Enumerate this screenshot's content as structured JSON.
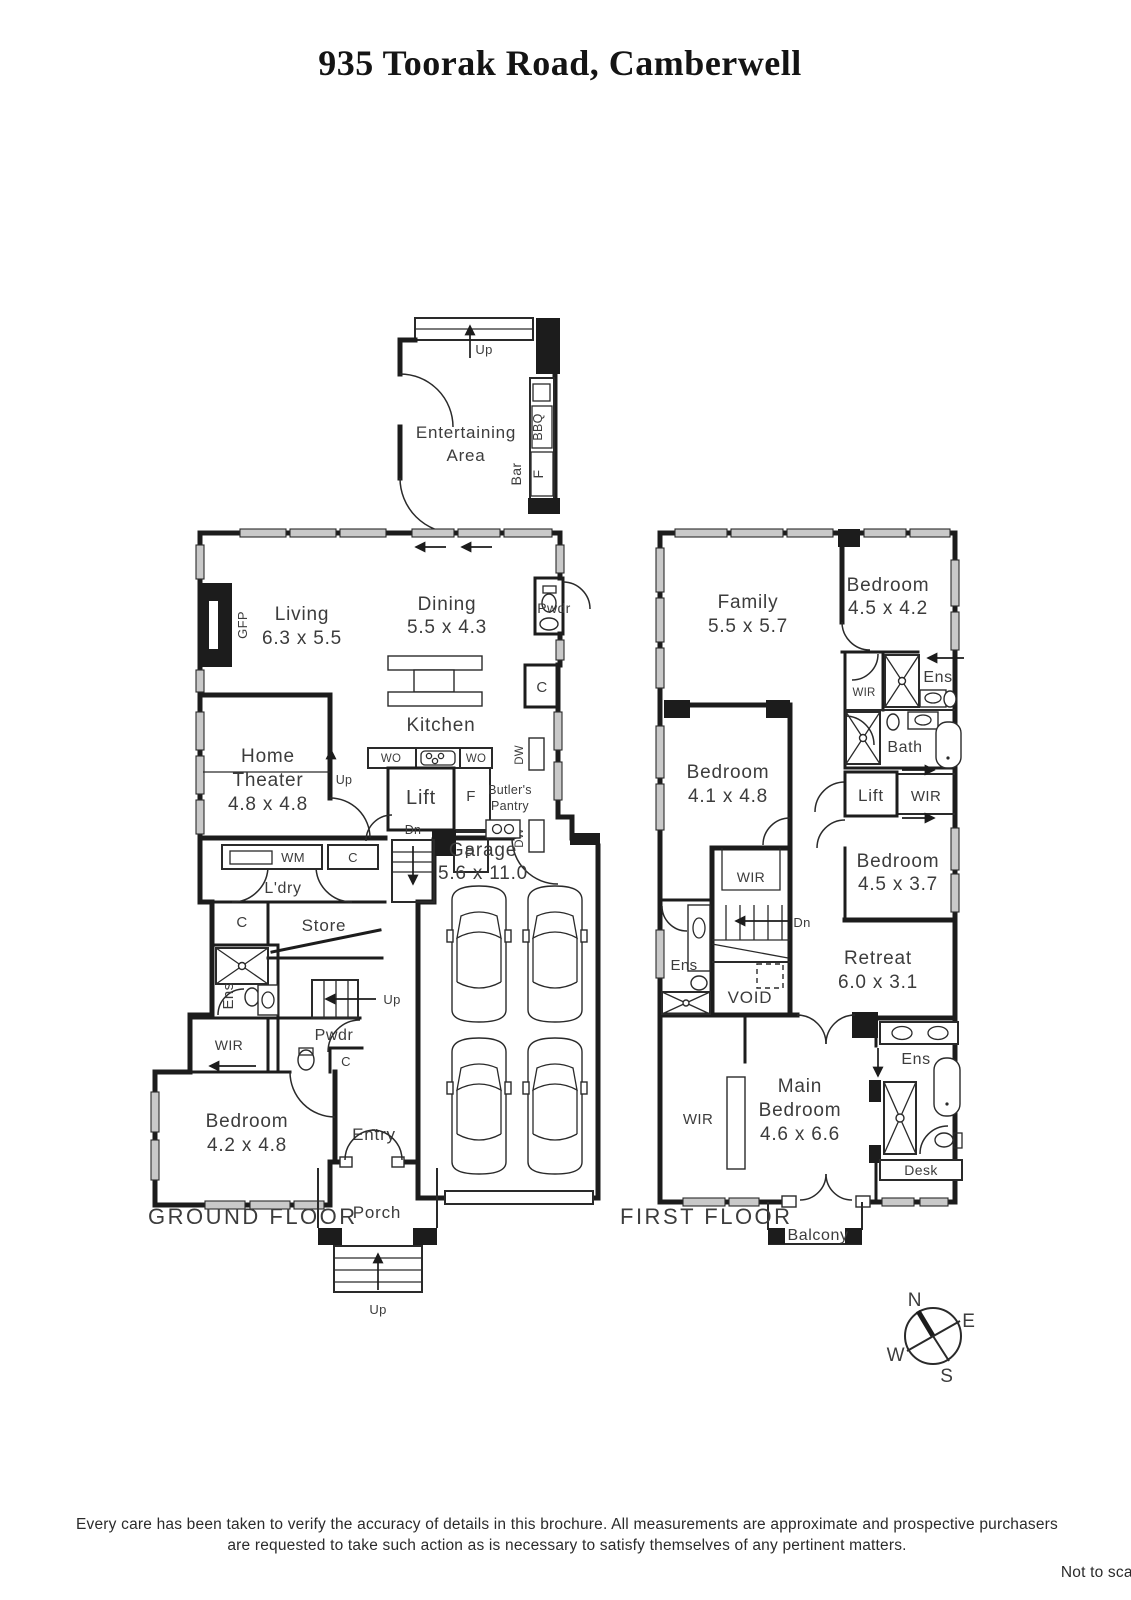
{
  "title": "935 Toorak Road, Camberwell",
  "g": {
    "label": "GROUND FLOOR",
    "entertaining1": "Entertaining",
    "entertaining2": "Area",
    "up1": "Up",
    "bbq": "BBQ",
    "bar": "Bar",
    "fridge_ent": "F",
    "living": "Living",
    "living_dim": "6.3 x 5.5",
    "gfp": "GFP",
    "dining": "Dining",
    "dining_dim": "5.5 x 4.3",
    "pwdr_upper": "Pwdr",
    "c1": "C",
    "kitchen": "Kitchen",
    "wo1": "WO",
    "wo2": "WO",
    "dw1": "DW",
    "dw2": "DW",
    "lift": "Lift",
    "fridge": "F",
    "butlers1": "Butler's",
    "butlers2": "Pantry",
    "pantry": "P",
    "dn": "Dn",
    "home1": "Home",
    "home2": "Theater",
    "home_dim": "4.8 x 4.8",
    "up2": "Up",
    "wm": "WM",
    "c2": "C",
    "ldry": "L'dry",
    "store": "Store",
    "c3": "C",
    "ens": "Ens",
    "up3": "Up",
    "wir": "WIR",
    "pwdr_lower": "Pwdr",
    "c4": "C",
    "bedroom": "Bedroom",
    "bedroom_dim": "4.2 x 4.8",
    "entry": "Entry",
    "porch": "Porch",
    "up4": "Up",
    "garage": "Garage",
    "garage_dim": "5.6 x 11.0"
  },
  "f": {
    "label": "FIRST FLOOR",
    "family": "Family",
    "family_dim": "5.5 x 5.7",
    "bedroom2": "Bedroom",
    "bedroom2_dim": "4.5 x 4.2",
    "wir1": "WIR",
    "ens1": "Ens",
    "bath": "Bath",
    "lift": "Lift",
    "wir2": "WIR",
    "bedroom3": "Bedroom",
    "bedroom3_dim": "4.1 x 4.8",
    "wir3": "WIR",
    "bedroom4": "Bedroom",
    "bedroom4_dim": "4.5 x 3.7",
    "dn": "Dn",
    "ens2": "Ens",
    "void": "VOID",
    "retreat": "Retreat",
    "retreat_dim": "6.0 x 3.1",
    "main1": "Main",
    "main2": "Bedroom",
    "main_dim": "4.6 x 6.6",
    "wir4": "WIR",
    "ens3": "Ens",
    "desk": "Desk",
    "balcony": "Balcony"
  },
  "compass": {
    "n": "N",
    "e": "E",
    "s": "S",
    "w": "W"
  },
  "footer": {
    "line1": "Every care has been taken to verify the accuracy of details in this brochure.  All measurements are approximate and prospective purchasers",
    "line2": "are requested to take such action as is necessary to satisfy themselves of any pertinent matters.",
    "scale": "Not to scale"
  }
}
